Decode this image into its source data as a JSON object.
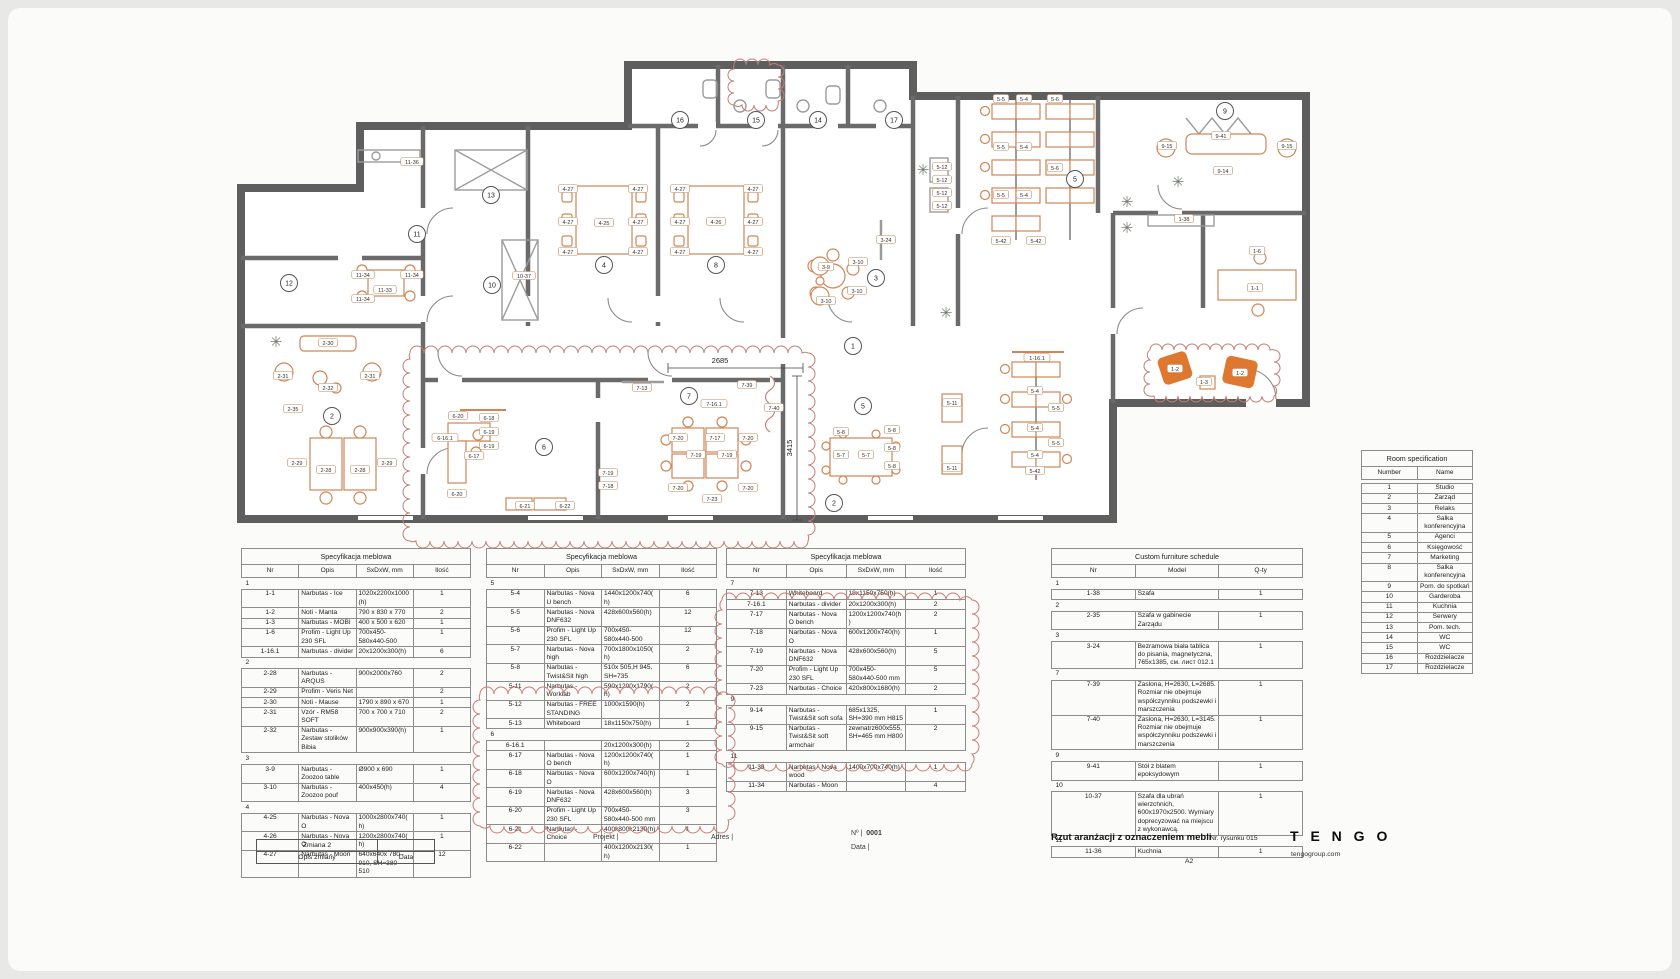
{
  "colors": {
    "wall": "#5e5e5e",
    "interior_wall": "#6a6a6a",
    "furniture": "#cf8656",
    "furniture_fill": "#e0772e",
    "gray_item": "#9b9b9b",
    "revision_cloud": "#c47d74",
    "table_border": "#8d8d8d"
  },
  "title_block": {
    "project_label": "Projekt |",
    "address_label": "Adres |",
    "number_label": "Nº |",
    "number_value": "0001",
    "date_label": "Data |",
    "drawing_title": "Rzut aranżacji z oznaczeniem mebli",
    "drawing_no_label": "Nr. rysunku",
    "drawing_no": "015",
    "logo": "T E N G O",
    "logo_site": "tengogroup.com",
    "sheet_format": "A2"
  },
  "revision_block": {
    "change": "Zmiana 2",
    "desc": "Opis zmiany",
    "date": "Data"
  },
  "spec_tables": [
    {
      "title": "Specyfikacja meblowa",
      "headers": [
        "Nr",
        "Opis",
        "SxDxW, mm",
        "Ilość"
      ],
      "groups": [
        {
          "label": "1",
          "rows": [
            [
              "1-1",
              "Narbutas - Ice",
              "1020x2200x1000(h)",
              "1"
            ],
            [
              "1-2",
              "Noti - Manta",
              "790 x 830 x 770",
              "2"
            ],
            [
              "1-3",
              "Narbutas - MOBI",
              "400 x 500 x 620",
              "1"
            ],
            [
              "1-6",
              "Profim - Light Up 230 SFL",
              "700x450-580x440-500",
              "1"
            ],
            [
              "1-16.1",
              "Narbutas - divider",
              "20x1200x300(h)",
              "6"
            ]
          ]
        },
        {
          "label": "2",
          "rows": [
            [
              "2-28",
              "Narbutas - ARQUS",
              "900x2000x760",
              "2"
            ],
            [
              "2-29",
              "Profim - Veris Net",
              "",
              "2"
            ],
            [
              "2-30",
              "Noti - Mause",
              "1790 x 890 x 670",
              "1"
            ],
            [
              "2-31",
              "Vzór - RM58 SOFT",
              "700 x 700 x 710",
              "2"
            ],
            [
              "2-32",
              "Narbutas - Zestaw stolików Bibia",
              "900x900x390(h)",
              "1"
            ]
          ]
        },
        {
          "label": "3",
          "rows": [
            [
              "3-9",
              "Narbutas - Zoozoo table",
              "Ø900 x 690",
              "1"
            ],
            [
              "3-10",
              "Narbutas - Zoozoo pouf",
              "400x450(h)",
              "4"
            ]
          ]
        },
        {
          "label": "4",
          "rows": [
            [
              "4-25",
              "Narbutas - Nova O",
              "1000x2800x740(h)",
              "1"
            ],
            [
              "4-26",
              "Narbutas - Nova O",
              "1200x2800x740(h)",
              "1"
            ],
            [
              "4-27",
              "Narbutas - Moon",
              "640x640x 780 - 910, SH=380 - 510",
              "12"
            ]
          ]
        }
      ]
    },
    {
      "title": "Specyfikacja meblowa",
      "headers": [
        "Nr",
        "Opis",
        "SxDxW, mm",
        "Ilość"
      ],
      "groups": [
        {
          "label": "5",
          "rows": [
            [
              "5-4",
              "Narbutas - Nova U bench",
              "1440x1200x740(h)",
              "6"
            ],
            [
              "5-5",
              "Narbutas - Nova DNF632",
              "428x600x560(h)",
              "12"
            ],
            [
              "5-6",
              "Profim - Light Up 230 SFL",
              "700x450-580x440-500",
              "12"
            ],
            [
              "5-7",
              "Narbutas - Nova high",
              "700x1800x1050(h)",
              "2"
            ],
            [
              "5-8",
              "Narbutas - Twist&Sit high",
              "510x 505,H 945, SH=735",
              "6"
            ],
            [
              "5-11",
              "Narbutas - Worklab",
              "590x1200x1790(h)",
              "2"
            ],
            [
              "5-12",
              "Narbutas - FREE STANDING",
              "1000x1590(h)",
              "2"
            ],
            [
              "5-13",
              "Whiteboard",
              "18x1150x750(h)",
              "1"
            ]
          ]
        },
        {
          "label": "6",
          "rows": [
            [
              "6-16.1",
              "",
              "20x1200x300(h)",
              "2"
            ],
            [
              "6-17",
              "Narbutas - Nova O bench",
              "1200x1200x740(h)",
              "1"
            ],
            [
              "6-18",
              "Narbutas - Nova O",
              "600x1200x740(h)",
              "1"
            ],
            [
              "6-19",
              "Narbutas - Nova DNF632",
              "428x600x560(h)",
              "3"
            ],
            [
              "6-20",
              "Profim - Light Up 230 SFL",
              "700x450-580x440-500 mm",
              "3"
            ],
            [
              "6-21",
              "Narbutas - Choice",
              "400x800x2130(h)",
              "1"
            ],
            [
              "6-22",
              "",
              "400x1200x2130(h)",
              "1"
            ]
          ]
        }
      ]
    },
    {
      "title": "Specyfikacja meblowa",
      "headers": [
        "Nr",
        "Opis",
        "SxDxW, mm",
        "Ilość"
      ],
      "groups": [
        {
          "label": "7",
          "rows": [
            [
              "7-13",
              "Whiteboard",
              "18x1150x750(h)",
              "1"
            ],
            [
              "7-16.1",
              "Narbutas - divider",
              "20x1200x300(h)",
              "2"
            ],
            [
              "7-17",
              "Narbutas - Nova O bench",
              "1200x1200x740(h)",
              "2"
            ],
            [
              "7-18",
              "Narbutas - Nova O",
              "600x1200x740(h)",
              "1"
            ],
            [
              "7-19",
              "Narbutas - Nova DNF632",
              "428x600x560(h)",
              "5"
            ],
            [
              "7-20",
              "Profim - Light Up 230 SFL",
              "700x450-580x440-500 mm",
              "5"
            ],
            [
              "7-23",
              "Narbutas - Choice",
              "420x800x1680(h)",
              "2"
            ]
          ]
        },
        {
          "label": "9",
          "rows": [
            [
              "9-14",
              "Narbutas - Twist&Sit soft sofa",
              "685x1325, SH=390 mm H815",
              "1"
            ],
            [
              "9-15",
              "Narbutas - Twist&Sit soft armchair",
              "zewnatrz600x555, SH=465 mm H800",
              "2"
            ]
          ]
        },
        {
          "label": "11",
          "rows": [
            [
              "11-33",
              "Narbutas - Nova wood",
              "1400x700x740(h)",
              "1"
            ],
            [
              "11-34",
              "Narbutas - Moon",
              "",
              "4"
            ]
          ]
        }
      ]
    },
    {
      "title": "Custom furniture schedule",
      "headers": [
        "Nr",
        "Model",
        "Q-ty"
      ],
      "groups": [
        {
          "label": "1",
          "rows": [
            [
              "1-38",
              "Szafa",
              "1"
            ]
          ]
        },
        {
          "label": "2",
          "rows": [
            [
              "2-35",
              "Szafa w gabinecie Zarządu",
              "1"
            ]
          ]
        },
        {
          "label": "3",
          "rows": [
            [
              "3-24",
              "Bezramowa biała tablica do pisania, magnetyczna, 765x1385, см. лист 012.1",
              "1"
            ]
          ]
        },
        {
          "label": "7",
          "rows": [
            [
              "7-39",
              "Zaslona, H=2630, L=2685. Rozmiar nie obejmuje współczynniku podszewki i marszczenia",
              "1"
            ],
            [
              "7-40",
              "Zaslona, H=2630, L=3145. Rozmiar nie obejmuje współczynniku podszewki i marszczenia",
              "1"
            ]
          ]
        },
        {
          "label": "9",
          "rows": [
            [
              "9-41",
              "Stół z blatem epoksydowym",
              "1"
            ]
          ]
        },
        {
          "label": "10",
          "rows": [
            [
              "10-37",
              "Szafa dla ubrań wierzchnich, 600x1970x2500. Wymiary doprecyzować na miejscu z wykonawcą.",
              "1"
            ]
          ]
        },
        {
          "label": "11",
          "rows": [
            [
              "11-36",
              "Kuchnia",
              "1"
            ]
          ]
        }
      ]
    }
  ],
  "room_spec": {
    "title": "Room specification",
    "headers": [
      "Number",
      "Name"
    ],
    "rows": [
      [
        "1",
        "Studio"
      ],
      [
        "2",
        "Zarząd"
      ],
      [
        "3",
        "Relaks"
      ],
      [
        "4",
        "Salka konferencyjna"
      ],
      [
        "5",
        "Agenci"
      ],
      [
        "6",
        "Księgowość"
      ],
      [
        "7",
        "Marketing"
      ],
      [
        "8",
        "Salka konferencyjna"
      ],
      [
        "9",
        "Pom. do spotkań"
      ],
      [
        "10",
        "Garderoba"
      ],
      [
        "11",
        "Kuchnia"
      ],
      [
        "12",
        "Serwery"
      ],
      [
        "13",
        "Pom. tech."
      ],
      [
        "14",
        "WC"
      ],
      [
        "15",
        "WC"
      ],
      [
        "16",
        "Rozdzielacze"
      ],
      [
        "17",
        "Rozdzielacze"
      ]
    ]
  },
  "plan": {
    "bubbles": [
      {
        "n": "16",
        "x": 672,
        "y": 112
      },
      {
        "n": "15",
        "x": 748,
        "y": 112
      },
      {
        "n": "14",
        "x": 810,
        "y": 112
      },
      {
        "n": "17",
        "x": 886,
        "y": 112
      },
      {
        "n": "9",
        "x": 1217,
        "y": 103
      },
      {
        "n": "11",
        "x": 409,
        "y": 226
      },
      {
        "n": "13",
        "x": 483,
        "y": 187
      },
      {
        "n": "12",
        "x": 281,
        "y": 275
      },
      {
        "n": "10",
        "x": 484,
        "y": 277
      },
      {
        "n": "4",
        "x": 596,
        "y": 257
      },
      {
        "n": "8",
        "x": 708,
        "y": 257
      },
      {
        "n": "3",
        "x": 868,
        "y": 270
      },
      {
        "n": "5",
        "x": 1067,
        "y": 171
      },
      {
        "n": "1",
        "x": 845,
        "y": 338
      },
      {
        "n": "2",
        "x": 324,
        "y": 408
      },
      {
        "n": "6",
        "x": 536,
        "y": 439
      },
      {
        "n": "7",
        "x": 681,
        "y": 388
      },
      {
        "n": "5",
        "x": 855,
        "y": 398
      },
      {
        "n": "2",
        "x": 826,
        "y": 495
      }
    ],
    "dimensions": [
      {
        "t": "2685",
        "x": 712,
        "y": 355,
        "rot": 0
      },
      {
        "t": "3415",
        "x": 784,
        "y": 440,
        "rot": -90
      }
    ],
    "tags": [
      [
        "11-36",
        404,
        154
      ],
      [
        "11-34",
        355,
        267
      ],
      [
        "11-34",
        404,
        267
      ],
      [
        "11-33",
        377,
        282
      ],
      [
        "11-34",
        355,
        291
      ],
      [
        "10-37",
        516,
        268
      ],
      [
        "4-27",
        560,
        181
      ],
      [
        "4-27",
        560,
        214
      ],
      [
        "4-27",
        560,
        244
      ],
      [
        "4-25",
        596,
        215
      ],
      [
        "4-27",
        630,
        181
      ],
      [
        "4-27",
        630,
        214
      ],
      [
        "4-27",
        630,
        244
      ],
      [
        "4-27",
        672,
        181
      ],
      [
        "4-27",
        672,
        214
      ],
      [
        "4-27",
        672,
        244
      ],
      [
        "4-26",
        708,
        214
      ],
      [
        "4-27",
        745,
        181
      ],
      [
        "4-27",
        745,
        214
      ],
      [
        "4-27",
        745,
        244
      ],
      [
        "3-9",
        818,
        259
      ],
      [
        "3-10",
        850,
        254
      ],
      [
        "3-10",
        818,
        293
      ],
      [
        "3-10",
        849,
        283
      ],
      [
        "3-24",
        878,
        232
      ],
      [
        "5-12",
        934,
        159
      ],
      [
        "5-12",
        934,
        172
      ],
      [
        "5-12",
        934,
        185
      ],
      [
        "5-12",
        934,
        198
      ],
      [
        "5-5",
        993,
        91
      ],
      [
        "5-4",
        1016,
        91
      ],
      [
        "5-6",
        1047,
        91
      ],
      [
        "5-5",
        993,
        139
      ],
      [
        "5-4",
        1016,
        139
      ],
      [
        "5-5",
        993,
        187
      ],
      [
        "5-4",
        1016,
        187
      ],
      [
        "5-6",
        1047,
        160
      ],
      [
        "5-42",
        993,
        233
      ],
      [
        "5-42",
        1028,
        233
      ],
      [
        "9-41",
        1213,
        128
      ],
      [
        "9-15",
        1159,
        138
      ],
      [
        "9-15",
        1279,
        138
      ],
      [
        "9-14",
        1215,
        163
      ],
      [
        "1-38",
        1176,
        211
      ],
      [
        "1-6",
        1249,
        243
      ],
      [
        "1-1",
        1247,
        280
      ],
      [
        "1-2",
        1167,
        361
      ],
      [
        "1-3",
        1196,
        374
      ],
      [
        "1-2",
        1232,
        365
      ],
      [
        "1-16.1",
        1029,
        350
      ],
      [
        "5-4",
        1027,
        383
      ],
      [
        "5-5",
        1048,
        400
      ],
      [
        "5-4",
        1027,
        420
      ],
      [
        "5-5",
        1048,
        435
      ],
      [
        "5-4",
        1027,
        447
      ],
      [
        "5-42",
        1027,
        463
      ],
      [
        "5-11",
        944,
        395
      ],
      [
        "5-11",
        944,
        460
      ],
      [
        "5-7",
        833,
        447
      ],
      [
        "5-7",
        858,
        447
      ],
      [
        "5-8",
        884,
        422
      ],
      [
        "5-8",
        884,
        440
      ],
      [
        "5-8",
        884,
        458
      ],
      [
        "5-8",
        833,
        424
      ],
      [
        "6-20",
        450,
        408
      ],
      [
        "6-16.1",
        437,
        430
      ],
      [
        "6-17",
        466,
        448
      ],
      [
        "6-18",
        481,
        410
      ],
      [
        "6-19",
        481,
        424
      ],
      [
        "6-19",
        481,
        438
      ],
      [
        "6-20",
        449,
        486
      ],
      [
        "6-21",
        517,
        498
      ],
      [
        "6-22",
        557,
        498
      ],
      [
        "7-13",
        634,
        380
      ],
      [
        "7-39",
        739,
        377
      ],
      [
        "7-40",
        766,
        400
      ],
      [
        "7-16.1",
        706,
        396
      ],
      [
        "7-17",
        707,
        430
      ],
      [
        "7-19",
        688,
        447
      ],
      [
        "7-19",
        719,
        447
      ],
      [
        "7-20",
        670,
        430
      ],
      [
        "7-20",
        740,
        430
      ],
      [
        "7-19",
        600,
        465
      ],
      [
        "7-18",
        600,
        478
      ],
      [
        "7-20",
        670,
        480
      ],
      [
        "7-20",
        740,
        480
      ],
      [
        "7-23",
        704,
        491
      ],
      [
        "2-30",
        320,
        335
      ],
      [
        "2-31",
        275,
        368
      ],
      [
        "2-31",
        362,
        368
      ],
      [
        "2-35",
        285,
        401
      ],
      [
        "2-32",
        320,
        380
      ],
      [
        "2-29",
        289,
        455
      ],
      [
        "2-28",
        318,
        462
      ],
      [
        "2-28",
        352,
        462
      ],
      [
        "2-29",
        379,
        455
      ]
    ]
  }
}
